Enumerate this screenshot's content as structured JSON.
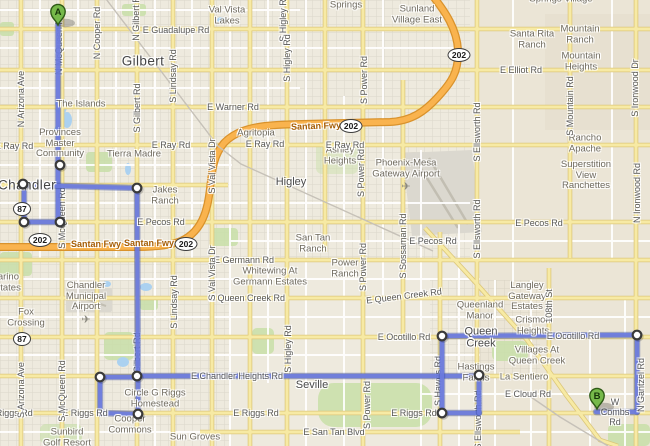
{
  "map": {
    "description": "Google Maps driving route with waypoints from marker A (Gilbert) to marker B (Queen Creek)",
    "route_color": "#6b7be0",
    "markers": [
      {
        "label": "A",
        "x": 58,
        "y": 25
      },
      {
        "label": "B",
        "x": 597,
        "y": 409
      }
    ],
    "segments": [
      [
        [
          58,
          25
        ],
        [
          58,
          222
        ]
      ],
      [
        [
          24,
          185
        ],
        [
          137,
          188
        ]
      ],
      [
        [
          24,
          185
        ],
        [
          24,
          222
        ]
      ],
      [
        [
          24,
          222
        ],
        [
          58,
          222
        ]
      ],
      [
        [
          137,
          188
        ],
        [
          138,
          415
        ]
      ],
      [
        [
          100,
          377
        ],
        [
          137,
          377
        ]
      ],
      [
        [
          100,
          377
        ],
        [
          100,
          413
        ]
      ],
      [
        [
          100,
          413
        ],
        [
          138,
          414
        ]
      ],
      [
        [
          137,
          376
        ],
        [
          479,
          376
        ]
      ],
      [
        [
          442,
          336
        ],
        [
          442,
          413
        ]
      ],
      [
        [
          442,
          336
        ],
        [
          637,
          335
        ]
      ],
      [
        [
          442,
          413
        ],
        [
          479,
          413
        ]
      ],
      [
        [
          479,
          376
        ],
        [
          479,
          413
        ]
      ],
      [
        [
          637,
          335
        ],
        [
          637,
          412
        ]
      ],
      [
        [
          637,
          412
        ],
        [
          596,
          412
        ]
      ]
    ],
    "waypoints": [
      [
        60,
        165
      ],
      [
        23,
        184
      ],
      [
        137,
        188
      ],
      [
        24,
        222
      ],
      [
        60,
        222
      ],
      [
        100,
        377
      ],
      [
        137,
        376
      ],
      [
        138,
        414
      ],
      [
        442,
        336
      ],
      [
        479,
        375
      ],
      [
        442,
        413
      ],
      [
        637,
        335
      ]
    ],
    "shields": [
      {
        "t": "202",
        "x": 40,
        "y": 240
      },
      {
        "t": "202",
        "x": 186,
        "y": 244
      },
      {
        "t": "202",
        "x": 351,
        "y": 126
      },
      {
        "t": "202",
        "x": 459,
        "y": 55
      },
      {
        "t": "87",
        "x": 22,
        "y": 209
      },
      {
        "t": "87",
        "x": 22,
        "y": 339
      }
    ],
    "labels": [
      {
        "t": "Gilbert",
        "x": 143,
        "y": 61,
        "c": "city"
      },
      {
        "t": "Chandler",
        "x": 27,
        "y": 185,
        "c": "city"
      },
      {
        "t": "Higley",
        "x": 291,
        "y": 182,
        "c": "town"
      },
      {
        "t": "Seville",
        "x": 312,
        "y": 385,
        "c": "town"
      },
      {
        "t": "Queen\nCreek",
        "x": 481,
        "y": 338,
        "c": "town"
      },
      {
        "t": "Val Vista\nLakes",
        "x": 227,
        "y": 16,
        "c": "place"
      },
      {
        "t": "Springs",
        "x": 346,
        "y": 6,
        "c": "place"
      },
      {
        "t": "Sunland\nVillage East",
        "x": 417,
        "y": 15,
        "c": "place"
      },
      {
        "t": "Springs Village",
        "x": 561,
        "y": 0,
        "c": "place"
      },
      {
        "t": "Santa Rita\nRanch",
        "x": 532,
        "y": 40,
        "c": "place"
      },
      {
        "t": "Mountain\nRanch",
        "x": 580,
        "y": 35,
        "c": "place"
      },
      {
        "t": "Mountain\nHeights",
        "x": 581,
        "y": 62,
        "c": "place"
      },
      {
        "t": "Rancho\nApache",
        "x": 585,
        "y": 144,
        "c": "place"
      },
      {
        "t": "Superstition\nView Ranchettes",
        "x": 586,
        "y": 176,
        "c": "place"
      },
      {
        "t": "The Islands",
        "x": 81,
        "y": 105,
        "c": "place"
      },
      {
        "t": "Provinces\nMaster\nCommunity",
        "x": 60,
        "y": 144,
        "c": "place"
      },
      {
        "t": "Tierra Madre",
        "x": 134,
        "y": 155,
        "c": "place"
      },
      {
        "t": "Jakes\nRanch",
        "x": 165,
        "y": 196,
        "c": "place"
      },
      {
        "t": "Agritopia",
        "x": 256,
        "y": 134,
        "c": "place"
      },
      {
        "t": "Ashley\nHeights",
        "x": 340,
        "y": 156,
        "c": "place"
      },
      {
        "t": "Phoenix-Mesa\nGateway Airport",
        "x": 406,
        "y": 169,
        "c": "place"
      },
      {
        "t": "San Tan\nRanch",
        "x": 313,
        "y": 244,
        "c": "place"
      },
      {
        "t": "Whitewing At\nGermann Estates",
        "x": 270,
        "y": 277,
        "c": "place"
      },
      {
        "t": "Power\nRanch",
        "x": 345,
        "y": 269,
        "c": "place"
      },
      {
        "t": "Chandler\nMunicipal\nAirport",
        "x": 86,
        "y": 297,
        "c": "place"
      },
      {
        "t": "Fox\nCrossing",
        "x": 26,
        "y": 318,
        "c": "place"
      },
      {
        "t": "Carino\nEstates",
        "x": 5,
        "y": 283,
        "c": "place"
      },
      {
        "t": "Sunbird\nGolf Resort",
        "x": 67,
        "y": 438,
        "c": "place"
      },
      {
        "t": "Cooper\nCommons",
        "x": 130,
        "y": 425,
        "c": "place"
      },
      {
        "t": "Circle G Riggs\nHomestead",
        "x": 155,
        "y": 399,
        "c": "place"
      },
      {
        "t": "Sun Groves",
        "x": 195,
        "y": 438,
        "c": "place"
      },
      {
        "t": "Queenland\nManor",
        "x": 480,
        "y": 311,
        "c": "place"
      },
      {
        "t": "Langley\nGateway\nEstates",
        "x": 527,
        "y": 297,
        "c": "place"
      },
      {
        "t": "Crismon\nHeights",
        "x": 533,
        "y": 326,
        "c": "place"
      },
      {
        "t": "Villages At\nQueen Creek",
        "x": 537,
        "y": 356,
        "c": "place"
      },
      {
        "t": "Hastings\nFarms",
        "x": 476,
        "y": 373,
        "c": "place"
      },
      {
        "t": "La Sentiero",
        "x": 524,
        "y": 378,
        "c": "place"
      },
      {
        "t": "E Guadalupe Rd",
        "x": 176,
        "y": 30,
        "c": "road"
      },
      {
        "t": "E Warner Rd",
        "x": 233,
        "y": 107,
        "c": "road"
      },
      {
        "t": "E Elliot Rd",
        "x": 521,
        "y": 70,
        "c": "road"
      },
      {
        "t": "E Ray Rd",
        "x": 14,
        "y": 146,
        "c": "road"
      },
      {
        "t": "E Ray Rd",
        "x": 171,
        "y": 145,
        "c": "road"
      },
      {
        "t": "E Ray Rd",
        "x": 265,
        "y": 144,
        "c": "road"
      },
      {
        "t": "E Ray Rd",
        "x": 345,
        "y": 145,
        "c": "road"
      },
      {
        "t": "E Pecos Rd",
        "x": 161,
        "y": 222,
        "c": "road"
      },
      {
        "t": "E Pecos Rd",
        "x": 433,
        "y": 241,
        "c": "road"
      },
      {
        "t": "E Pecos Rd",
        "x": 539,
        "y": 223,
        "c": "road"
      },
      {
        "t": "E Germann Rd",
        "x": 244,
        "y": 260,
        "c": "road"
      },
      {
        "t": "E Queen Creek Rd",
        "x": 247,
        "y": 298,
        "c": "road"
      },
      {
        "t": "E Queen Creek Rd",
        "x": 404,
        "y": 296,
        "c": "road",
        "r": -7
      },
      {
        "t": "E Ocotillo Rd",
        "x": 404,
        "y": 337,
        "c": "road"
      },
      {
        "t": "E Ocotillo Rd",
        "x": 573,
        "y": 336,
        "c": "road"
      },
      {
        "t": "E Chandler Heights Rd",
        "x": 237,
        "y": 376,
        "c": "road"
      },
      {
        "t": "E Riggs Rd",
        "x": 10,
        "y": 413,
        "c": "road"
      },
      {
        "t": "E Riggs Rd",
        "x": 85,
        "y": 413,
        "c": "road"
      },
      {
        "t": "E Riggs Rd",
        "x": 256,
        "y": 413,
        "c": "road"
      },
      {
        "t": "E Riggs Rd",
        "x": 414,
        "y": 413,
        "c": "road"
      },
      {
        "t": "E Cloud Rd",
        "x": 528,
        "y": 394,
        "c": "road"
      },
      {
        "t": "W Combs Rd",
        "x": 615,
        "y": 412,
        "c": "road"
      },
      {
        "t": "E San Tan Blvd",
        "x": 334,
        "y": 432,
        "c": "road"
      },
      {
        "t": "N Cooper Rd",
        "x": 97,
        "y": 33,
        "c": "roadv"
      },
      {
        "t": "N Gilbert Rd",
        "x": 136,
        "y": 16,
        "c": "roadv"
      },
      {
        "t": "S Lindsay Rd",
        "x": 173,
        "y": 76,
        "c": "roadv"
      },
      {
        "t": "S Gilbert Rd",
        "x": 137,
        "y": 108,
        "c": "roadv"
      },
      {
        "t": "N Arizona Ave",
        "x": 21,
        "y": 99,
        "c": "roadv"
      },
      {
        "t": "S Higley Rd",
        "x": 283,
        "y": 18,
        "c": "roadv"
      },
      {
        "t": "S Higley Rd",
        "x": 287,
        "y": 58,
        "c": "roadv"
      },
      {
        "t": "S Power Rd",
        "x": 364,
        "y": 80,
        "c": "roadv"
      },
      {
        "t": "S Power Rd",
        "x": 361,
        "y": 173,
        "c": "roadv"
      },
      {
        "t": "S Power Rd",
        "x": 363,
        "y": 267,
        "c": "roadv"
      },
      {
        "t": "S Power Rd",
        "x": 367,
        "y": 405,
        "c": "roadv"
      },
      {
        "t": "S Val Vista Dr",
        "x": 212,
        "y": 166,
        "c": "roadv"
      },
      {
        "t": "S Val Vista Dr",
        "x": 212,
        "y": 273,
        "c": "roadv"
      },
      {
        "t": "S Lindsay Rd",
        "x": 174,
        "y": 302,
        "c": "roadv"
      },
      {
        "t": "S Gilbert Rd",
        "x": 137,
        "y": 357,
        "c": "roadv",
        "u": true
      },
      {
        "t": "S McQueen Rd",
        "x": 62,
        "y": 391,
        "c": "roadv"
      },
      {
        "t": "S Arizona Ave",
        "x": 21,
        "y": 390,
        "c": "roadv"
      },
      {
        "t": "S Higley Rd",
        "x": 288,
        "y": 349,
        "c": "roadv"
      },
      {
        "t": "S Sossaman Rd",
        "x": 403,
        "y": 246,
        "c": "roadv"
      },
      {
        "t": "S Ellsworth Rd",
        "x": 477,
        "y": 132,
        "c": "roadv"
      },
      {
        "t": "S Ellsworth Rd",
        "x": 477,
        "y": 229,
        "c": "roadv"
      },
      {
        "t": "S Ellsworth Rd",
        "x": 478,
        "y": 420,
        "c": "roadv",
        "u": true
      },
      {
        "t": "S Mountain Rd",
        "x": 570,
        "y": 106,
        "c": "roadv"
      },
      {
        "t": "S Ironwood Dr",
        "x": 635,
        "y": 88,
        "c": "roadv"
      },
      {
        "t": "N Ironwood Rd",
        "x": 637,
        "y": 193,
        "c": "roadv"
      },
      {
        "t": "N Gantzel Rd",
        "x": 641,
        "y": 385,
        "c": "roadv"
      },
      {
        "t": "108th St",
        "x": 549,
        "y": 306,
        "c": "roadv"
      },
      {
        "t": "S Hawes Rd",
        "x": 438,
        "y": 381,
        "c": "roadv",
        "u": true
      },
      {
        "t": "N McQueen Rd",
        "x": 59,
        "y": 44,
        "c": "roadv",
        "u": true
      },
      {
        "t": "S McQueen Rd",
        "x": 62,
        "y": 218,
        "c": "roadv",
        "u": true
      },
      {
        "t": "Santan Fwy",
        "x": 96,
        "y": 244,
        "c": "fwy"
      },
      {
        "t": "Santan Fwy",
        "x": 149,
        "y": 243,
        "c": "fwy"
      },
      {
        "t": "Santan Fwy",
        "x": 316,
        "y": 126,
        "c": "fwy",
        "r": -2
      },
      {
        "t": "✈",
        "x": 406,
        "y": 187,
        "c": "plane",
        "n": "airport-airplane-icon"
      },
      {
        "t": "✈",
        "x": 86,
        "y": 320,
        "c": "plane",
        "n": "airport-airplane-icon"
      }
    ]
  }
}
